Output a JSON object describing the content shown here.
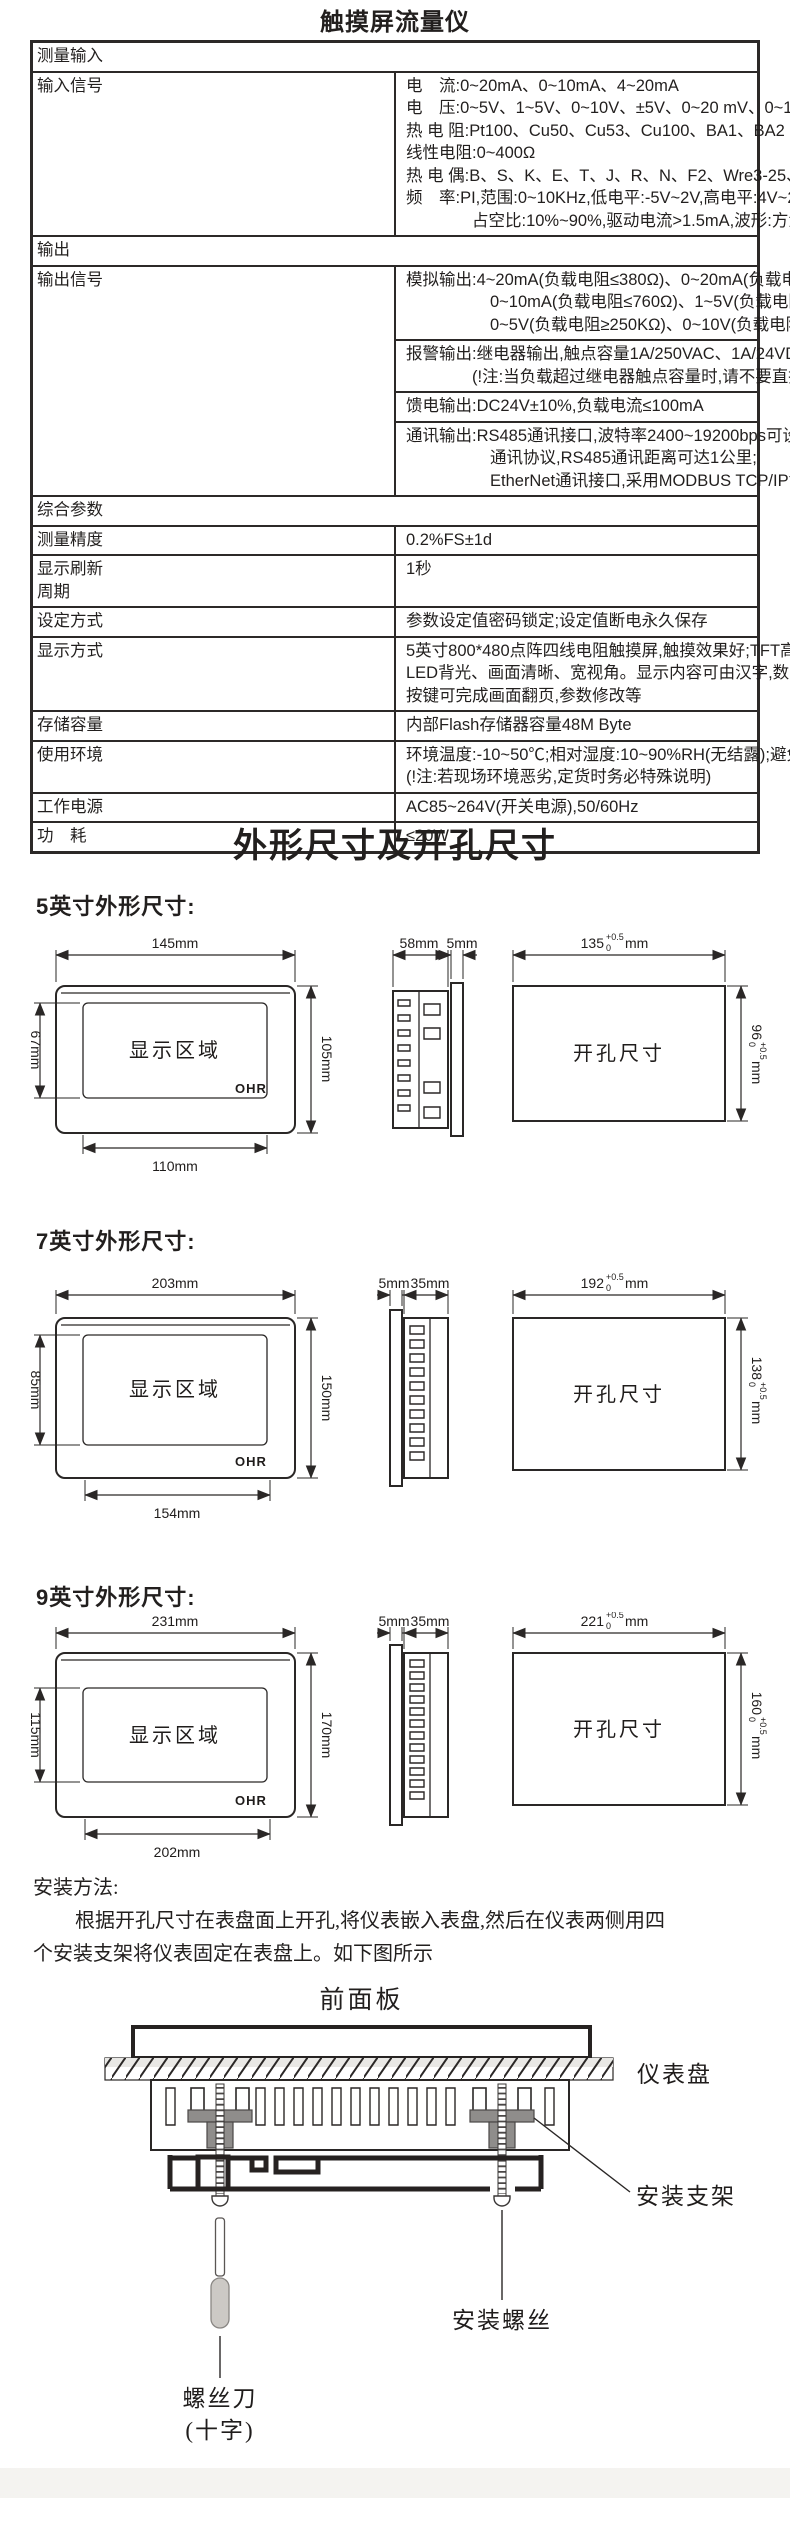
{
  "page_title": "触摸屏流量仪",
  "spec_table": {
    "section_measure": "测量输入",
    "input_signal": {
      "label": "输入信号",
      "lines": [
        "电　流:0~20mA、0~10mA、4~20mA",
        "电　压:0~5V、1~5V、0~10V、±5V、0~20 mV、0~100mV、±20mV、±100mV",
        "热 电 阻:Pt100、Cu50、Cu53、Cu100、BA1、BA2",
        "线性电阻:0~400Ω",
        "热 电 偶:B、S、K、E、T、J、R、N、F2、Wre3-25、Wre5-26",
        "频　率:PI,范围:0~10KHz,低电平:-5V~2V,高电平:4V~26V,",
        "占空比:10%~90%,驱动电流>1.5mA,波形:方波、正弦波、三角波等"
      ]
    },
    "section_output": "输出",
    "output_signal": {
      "label": "输出信号",
      "analog": [
        "模拟输出:4~20mA(负载电阻≤380Ω)、0~20mA(负载电阻≤380Ω)、",
        "0~10mA(负载电阻≤760Ω)、1~5V(负载电阻≥250KΩ)、",
        "0~5V(负载电阻≥250KΩ)、0~10V(负载电阻≥10KΩ)"
      ],
      "alarm": [
        "报警输出:继电器输出,触点容量1A/250VAC、1A/24VDC;固态继电器输出,12V/30mA",
        "(!注:当负载超过继电器触点容量时,请不要直接带负载)"
      ],
      "feed": "馈电输出:DC24V±10%,负载电流≤100mA",
      "comm": [
        "通讯输出:RS485通讯接口,波特率2400~19200bps可设置,采用标准MODBUS RTU",
        "通讯协议,RS485通讯距离可达1公里;",
        "EtherNet通讯接口,采用MODBUS TCP/IP协议,通讯速率为10/100M自适应。"
      ]
    },
    "section_general": "综合参数",
    "accuracy": {
      "label": "测量精度",
      "value": "0.2%FS±1d"
    },
    "refresh": {
      "label_line1": "显示刷新",
      "label_line2": "周期",
      "value": "1秒"
    },
    "setting": {
      "label": "设定方式",
      "value": "参数设定值密码锁定;设定值断电永久保存"
    },
    "display": {
      "label": "显示方式",
      "lines": [
        "5英寸800*480点阵四线电阻触摸屏,触摸效果好;TFT高亮度彩色图形液晶显示,",
        "LED背光、画面清晰、宽视角。显示内容可由汉字,数字,棒图等组成,通过触摸",
        "按键可完成画面翻页,参数修改等"
      ]
    },
    "storage": {
      "label": "存储容量",
      "value": "内部Flash存储器容量48M Byte"
    },
    "environment": {
      "label": "使用环境",
      "lines": [
        "环境温度:-10~50℃;相对湿度:10~90%RH(无结露);避免强腐蚀气体。",
        "(!注:若现场环境恶劣,定货时务必特殊说明)"
      ]
    },
    "power": {
      "label": "工作电源",
      "value": "AC85~264V(开关电源),50/60Hz"
    },
    "consumption": {
      "label": "功　耗",
      "value": "≤20W"
    }
  },
  "dimensions": {
    "section_title": "外形尺寸及开孔尺寸",
    "display_label": "显示区域",
    "cutout_label": "开孔尺寸",
    "logo": "OHR",
    "models": [
      {
        "heading": "5英寸外形尺寸:",
        "front_top": "145mm",
        "front_bottom": "110mm",
        "front_left": "67mm",
        "front_right": "105mm",
        "side_d1": "58mm",
        "side_d2": "5mm",
        "cut_w": "135",
        "cut_w_tp": "+0.5",
        "cut_w_tm": "0",
        "cut_w_unit": "mm",
        "cut_h": "96",
        "cut_h_tp": "+0.5",
        "cut_h_tm": "0",
        "cut_h_unit": "mm"
      },
      {
        "heading": "7英寸外形尺寸:",
        "front_top": "203mm",
        "front_bottom": "154mm",
        "front_left": "85mm",
        "front_right": "150mm",
        "side_d1": "5mm",
        "side_d2": "35mm",
        "cut_w": "192",
        "cut_w_tp": "+0.5",
        "cut_w_tm": "0",
        "cut_w_unit": "mm",
        "cut_h": "138",
        "cut_h_tp": "+0.5",
        "cut_h_tm": "0",
        "cut_h_unit": "mm"
      },
      {
        "heading": "9英寸外形尺寸:",
        "front_top": "231mm",
        "front_bottom": "202mm",
        "front_left": "115mm",
        "front_right": "170mm",
        "side_d1": "5mm",
        "side_d2": "35mm",
        "cut_w": "221",
        "cut_w_tp": "+0.5",
        "cut_w_tm": "0",
        "cut_w_unit": "mm",
        "cut_h": "160",
        "cut_h_tp": "+0.5",
        "cut_h_tm": "0",
        "cut_h_unit": "mm"
      }
    ]
  },
  "install": {
    "heading": "安装方法:",
    "para_line1": "根据开孔尺寸在表盘面上开孔,将仪表嵌入表盘,然后在仪表两侧用四",
    "para_line2": "个安装支架将仪表固定在表盘上。如下图所示",
    "front_panel_label": "前面板",
    "panel_label": "仪表盘",
    "bracket_label": "安装支架",
    "screw_label": "安装螺丝",
    "screwdriver_label1": "螺丝刀",
    "screwdriver_label2": "(十字)"
  }
}
